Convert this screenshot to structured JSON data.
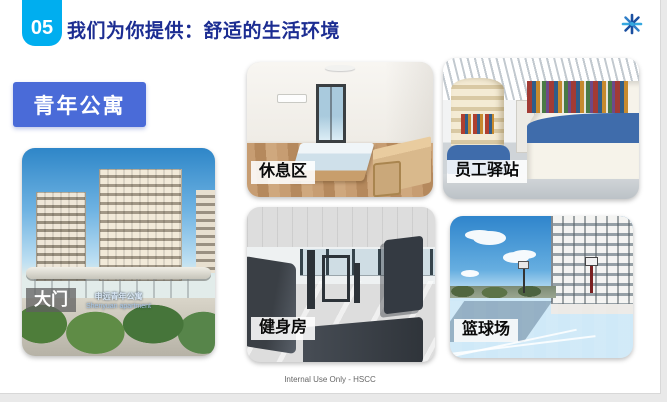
{
  "slide": {
    "number": "05",
    "title": "我们为你提供：舒适的生活环境",
    "section_tag": "青年公寓",
    "footer": "Internal Use Only - HSCC"
  },
  "photos": {
    "gate": {
      "label": "大门",
      "sign_cn": "申远青年公寓",
      "sign_en": "Shenyuan apartment"
    },
    "rest_area": {
      "label": "休息区"
    },
    "staff_station": {
      "label": "员工驿站"
    },
    "gym": {
      "label": "健身房"
    },
    "basketball_court": {
      "label": "篮球场"
    }
  },
  "icons": {
    "top_right": "snowflake-logo"
  },
  "colors": {
    "badge_cyan": "#00AEEF",
    "title_navy": "#1C2D92",
    "tag_blue": "#4A6BD8",
    "shelf_base_blue": "#3F6CAB",
    "court_blue": "#2E669C"
  }
}
